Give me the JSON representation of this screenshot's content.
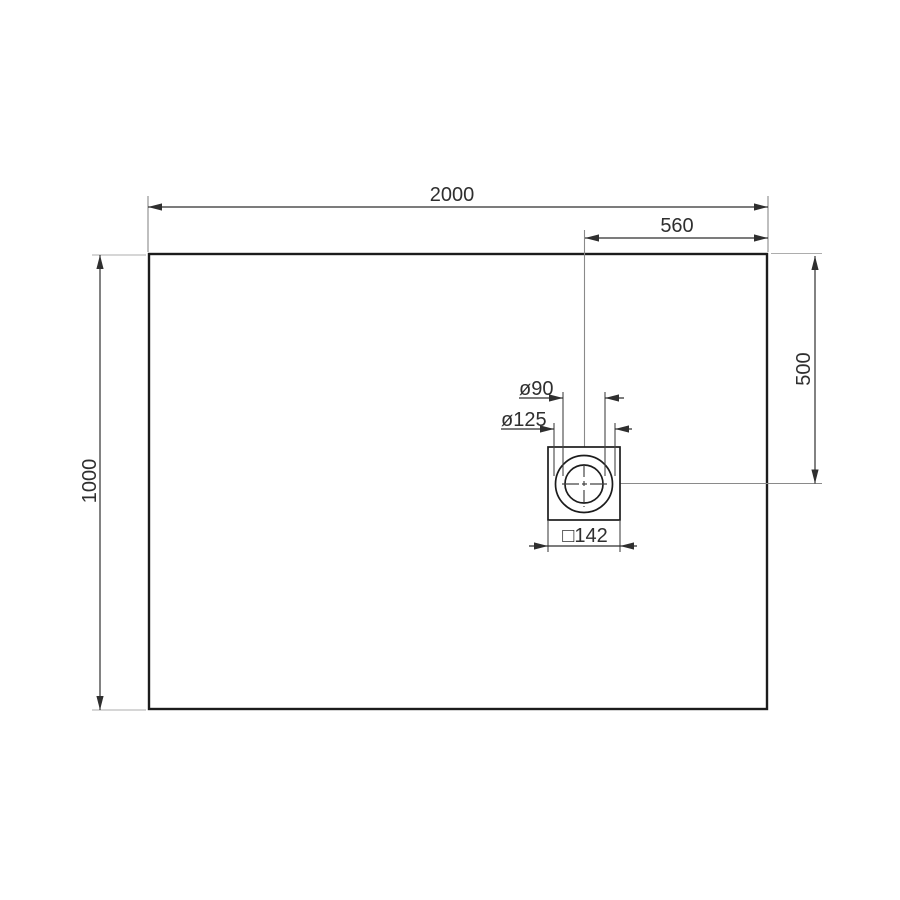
{
  "drawing": {
    "description": "Technical dimension drawing of a rectangular shower tray with offset square drain, top view"
  },
  "labels": {
    "width": "2000",
    "drain_offset_from_right": "560",
    "depth": "1000",
    "drain_offset_from_top": "500",
    "drain_hole_diameter": "ø90",
    "drain_flange_diameter": "ø125",
    "drain_square": "□142"
  },
  "dimensions_mm": {
    "tray_width": 2000,
    "tray_depth": 1000,
    "drain_center_from_right_edge": 560,
    "drain_center_from_top_edge": 500,
    "drain_hole_diameter": 90,
    "drain_flange_diameter": 125,
    "drain_square_size": 142
  },
  "colors": {
    "background": "#ffffff",
    "outline": "#1c1c1c",
    "dimension": "#2f2f2f",
    "extension_light": "#adadad",
    "extension_mid": "#8a8a8a",
    "extension_dark": "#454545",
    "text": "#2f2f2f"
  }
}
